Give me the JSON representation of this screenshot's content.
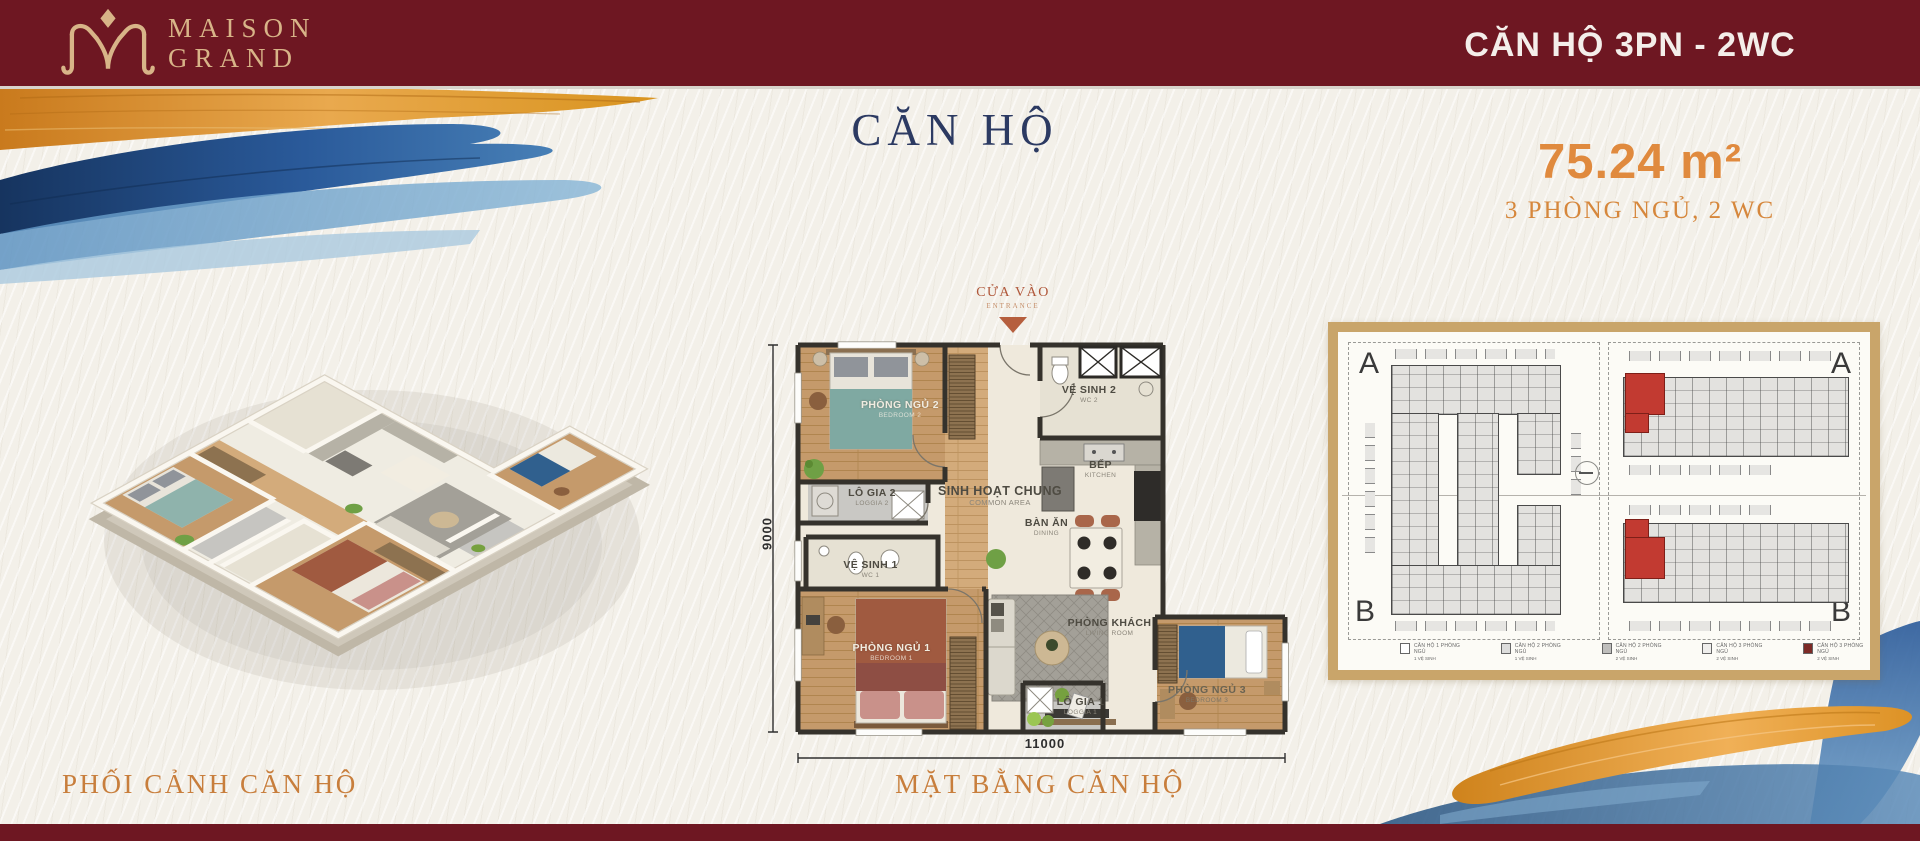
{
  "header": {
    "brand_line1": "MAISON",
    "brand_line2": "GRAND",
    "unit_type": "CĂN HỘ 3PN - 2WC"
  },
  "hero": {
    "title": "CĂN HỘ",
    "area_value": "75.24 m²",
    "area_detail": "3 PHÒNG NGỦ, 2 WC"
  },
  "perspective": {
    "caption": "PHỐI CẢNH CĂN HỘ"
  },
  "plan": {
    "caption": "MẶT BẰNG CĂN HỘ",
    "entrance": {
      "label": "CỬA VÀO",
      "sub": "ENTRANCE"
    },
    "dimensions": {
      "width": "11000",
      "height": "9000"
    },
    "rooms": {
      "bedroom2": {
        "name": "PHÒNG NGỦ 2",
        "sub": "BEDROOM 2"
      },
      "wc2": {
        "name": "VỆ SINH 2",
        "sub": "WC 2"
      },
      "loggia2": {
        "name": "LÔ GIA 2",
        "sub": "LOGGIA 2"
      },
      "common": {
        "name": "SINH HOẠT CHUNG",
        "sub": "COMMON AREA"
      },
      "kitchen": {
        "name": "BẾP",
        "sub": "KITCHEN"
      },
      "dining": {
        "name": "BÀN ĂN",
        "sub": "DINING"
      },
      "wc1": {
        "name": "VỆ SINH 1",
        "sub": "WC 1"
      },
      "bedroom1": {
        "name": "PHÒNG NGỦ 1",
        "sub": "BEDROOM 1"
      },
      "living": {
        "name": "PHÒNG KHÁCH",
        "sub": "LIVING ROOM"
      },
      "loggia1": {
        "name": "LÔ GIA 1",
        "sub": "LOGGIA 1"
      },
      "bedroom3": {
        "name": "PHÒNG NGỦ 3",
        "sub": "BEDROOM 3"
      }
    }
  },
  "key_plan": {
    "block_a_left": "A",
    "block_b_left": "B",
    "block_a_right": "A",
    "block_b_right": "B",
    "legend": [
      {
        "line1": "CĂN HỘ 1 PHÒNG NGỦ",
        "line2": "1 VỆ SINH"
      },
      {
        "line1": "CĂN HỘ 2 PHÒNG NGỦ",
        "line2": "1 VỆ SINH"
      },
      {
        "line1": "CĂN HỘ 2 PHÒNG NGỦ",
        "line2": "2 VỆ SINH"
      },
      {
        "line1": "CĂN HỘ 3 PHÒNG NGỦ",
        "line2": "2 VỆ SINH"
      },
      {
        "line1": "CĂN HỘ 3 PHÒNG NGỦ",
        "line2": "2 VỆ SINH"
      }
    ]
  },
  "colors": {
    "maroon": "#6e1722",
    "gold": "#d8b488",
    "orange_accent": "#e08a3e",
    "navy_title": "#2c3a62",
    "keyplan_frame": "#c9a56a",
    "highlight_unit": "#c23a31"
  }
}
